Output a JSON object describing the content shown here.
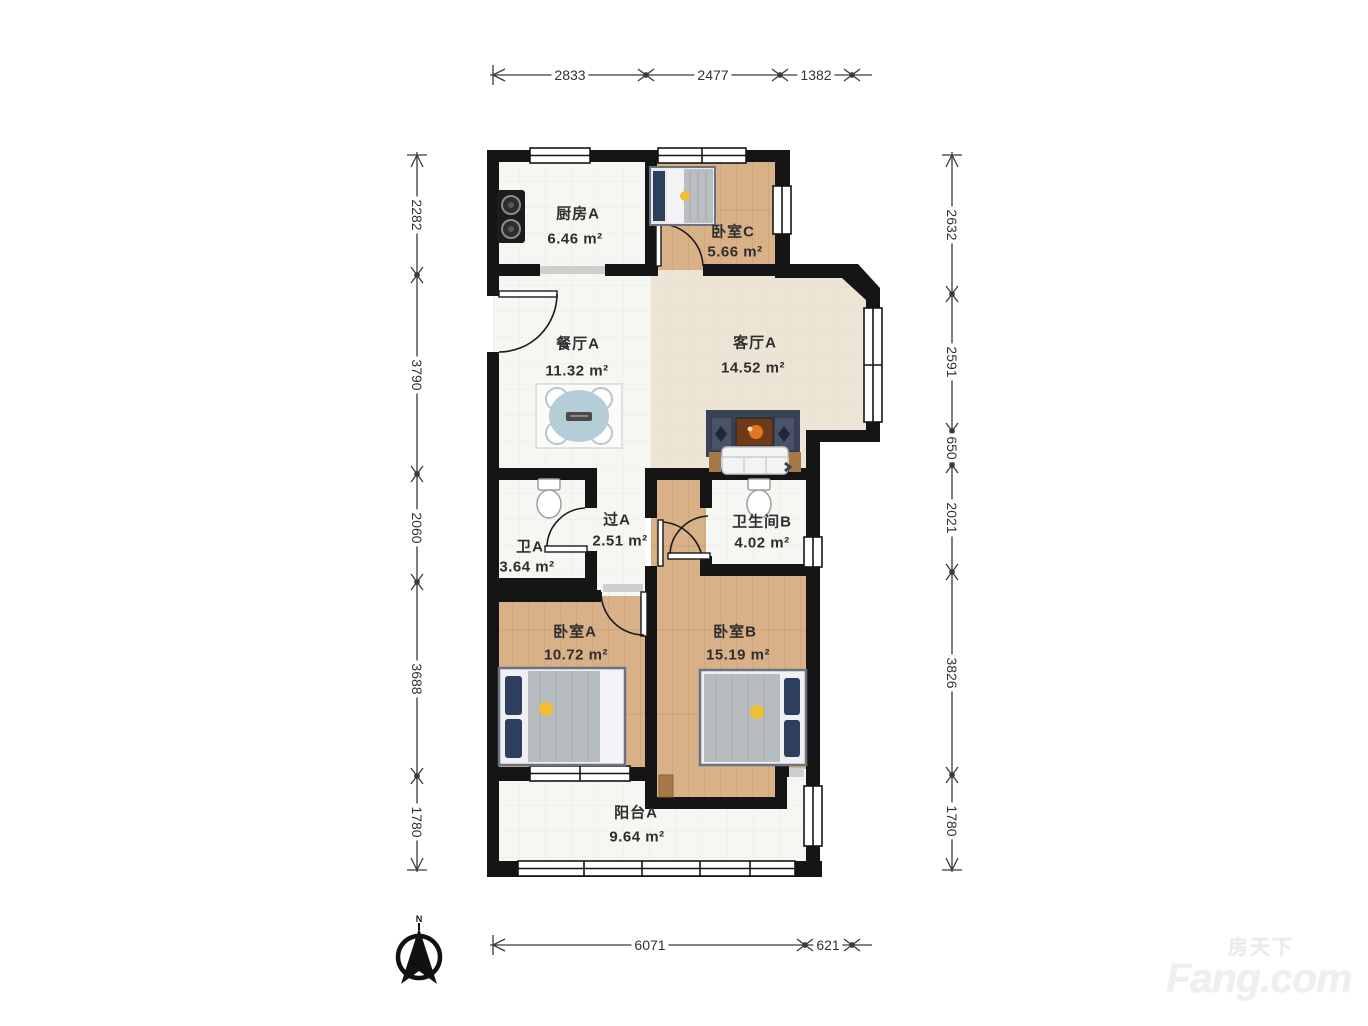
{
  "watermark": {
    "cn": "房天下",
    "en": "Fang.com"
  },
  "compass": {
    "label": "N"
  },
  "dimensions": {
    "top": [
      "2833",
      "2477",
      "1382"
    ],
    "left": [
      "2282",
      "3790",
      "2060",
      "3688",
      "1780"
    ],
    "right": [
      "2632",
      "2591",
      "650",
      "2021",
      "3826",
      "1780"
    ],
    "bottom": [
      "6071",
      "621"
    ]
  },
  "rooms": {
    "kitchen": {
      "name": "厨房A",
      "area": "6.46 m²"
    },
    "bedroom_c": {
      "name": "卧室C",
      "area": "5.66 m²"
    },
    "dining": {
      "name": "餐厅A",
      "area": "11.32 m²"
    },
    "living": {
      "name": "客厅A",
      "area": "14.52 m²"
    },
    "hallway": {
      "name": "过A",
      "area": "2.51 m²"
    },
    "bath_a": {
      "name": "卫A",
      "area": "3.64 m²"
    },
    "bath_b": {
      "name": "卫生间B",
      "area": "4.02 m²"
    },
    "bedroom_a": {
      "name": "卧室A",
      "area": "10.72 m²"
    },
    "bedroom_b": {
      "name": "卧室B",
      "area": "15.19 m²"
    },
    "balcony": {
      "name": "阳台A",
      "area": "9.64 m²"
    }
  }
}
